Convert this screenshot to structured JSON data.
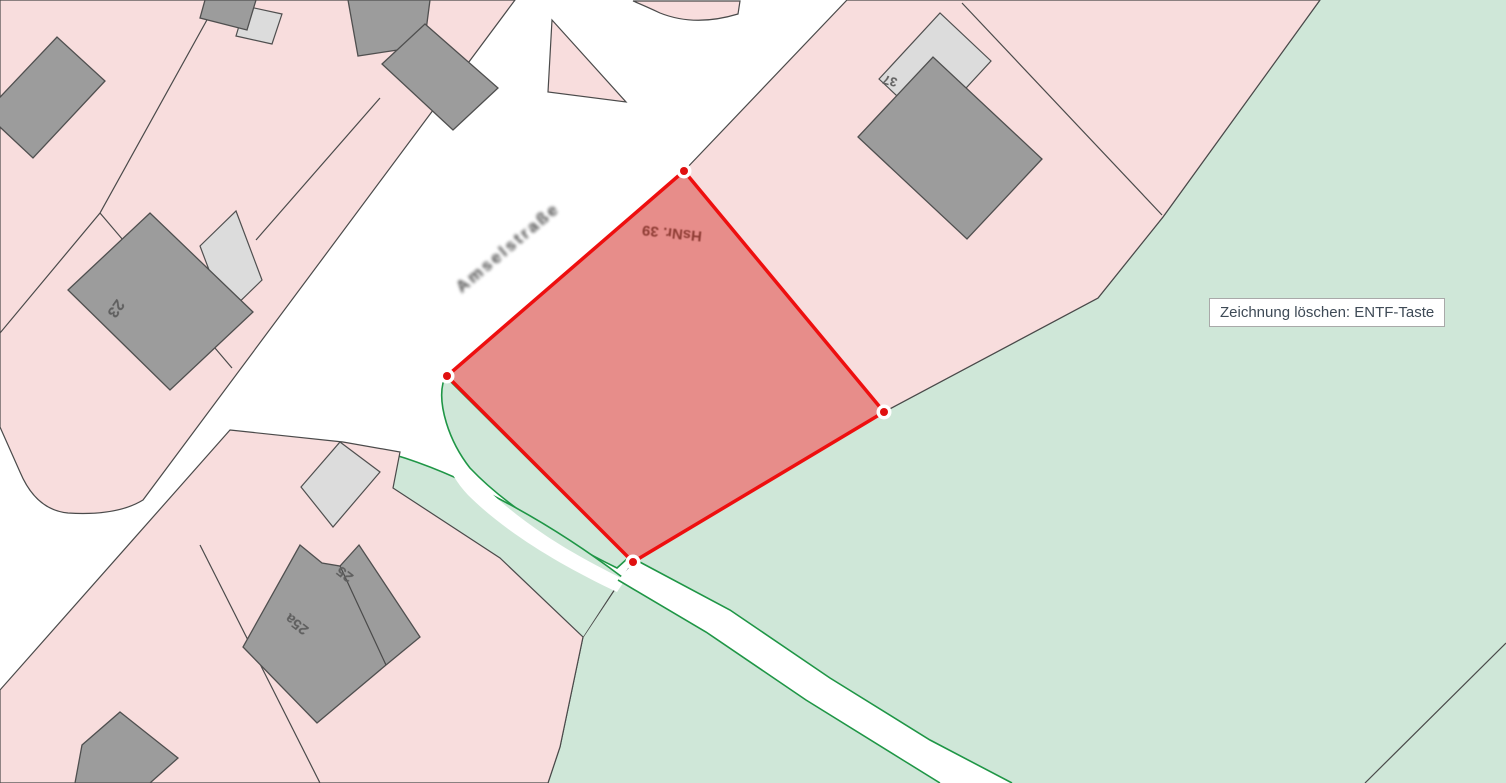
{
  "tooltip": {
    "text": "Zeichnung löschen: ENTF-Taste"
  },
  "map": {
    "street": {
      "name": "Amselstraße"
    },
    "selected_parcel": {
      "label": "HsNr. 39",
      "vertex_count": 4,
      "vertices_px": [
        [
          684,
          171
        ],
        [
          884,
          412
        ],
        [
          633,
          562
        ],
        [
          447,
          376
        ]
      ]
    },
    "house_numbers": {
      "h23": "23",
      "h25": "25",
      "h25a": "25a",
      "h37": "37"
    },
    "colors": {
      "parcel_fill": "#f8dddd",
      "building_fill": "#9c9c9c",
      "building_light_fill": "#dcdcdc",
      "green_fill": "#cfe7d8",
      "green_line": "#1f9646",
      "boundary_line": "#4a4a4a",
      "selection_stroke": "#ee0f0f",
      "selection_fill": "rgba(208,28,22,0.5)",
      "parcel_label_color": "#8e3c34",
      "tooltip_text_color": "#3e4a56"
    }
  }
}
